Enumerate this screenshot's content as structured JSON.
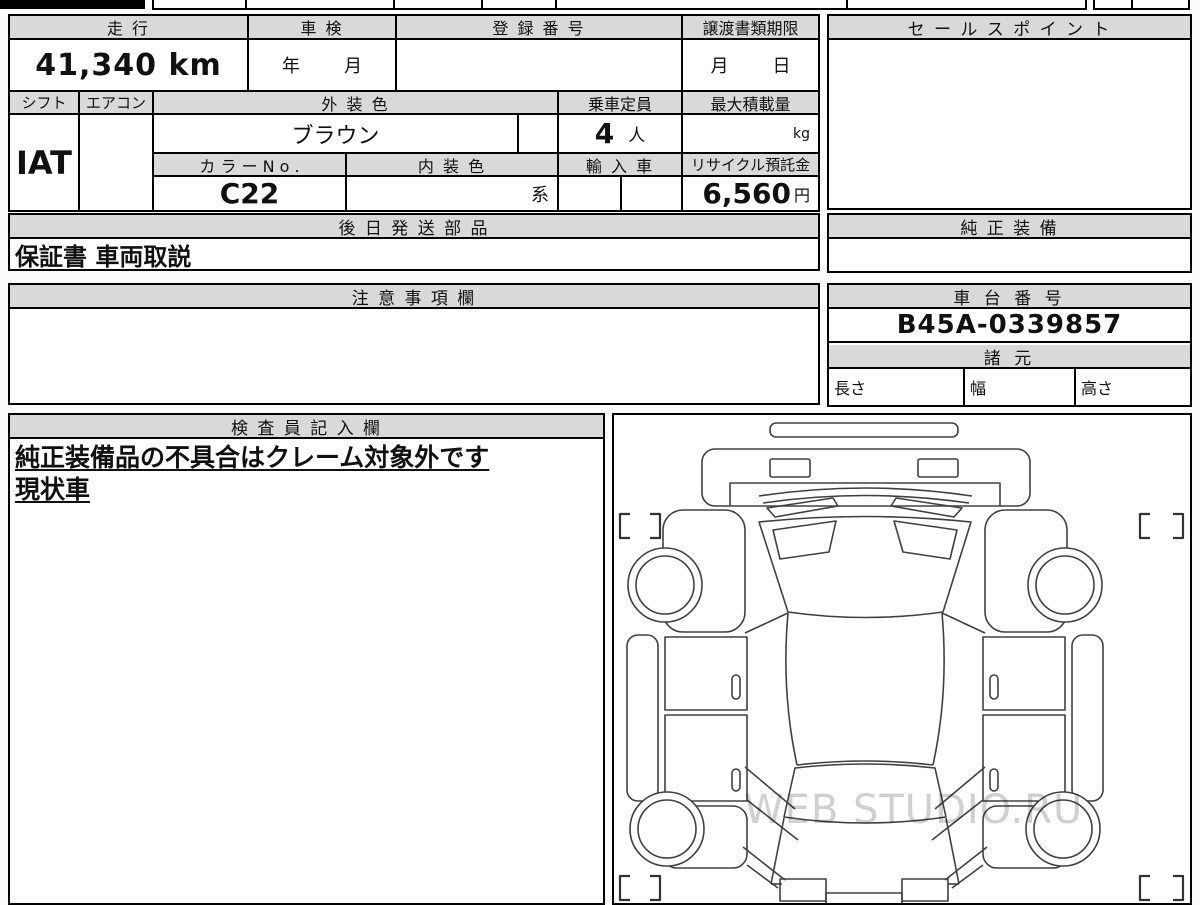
{
  "colors": {
    "header_bg": "#d9d9d9",
    "border": "#000000",
    "diagram_line": "#404040",
    "watermark": "#d0d0d0"
  },
  "table": {
    "headers": {
      "mileage": "走 行",
      "inspection": "車 検",
      "registration": "登 録 番 号",
      "transfer_deadline": "譲渡書類期限",
      "shift": "シフト",
      "aircon": "エアコン",
      "exterior_color": "外 装 色",
      "capacity": "乗車定員",
      "max_load": "最大積載量",
      "color_no": "カ ラ ー N o .",
      "interior_color": "内 装 色",
      "imported": "輸 入 車",
      "recycle_deposit": "リサイクル預託金",
      "later_shipped_parts": "後 日 発 送 部 品"
    },
    "values": {
      "mileage": "41,340 km",
      "inspection_year_label": "年",
      "inspection_month_label": "月",
      "transfer_month_label": "月",
      "transfer_day_label": "日",
      "shift": "IAT",
      "aircon": "",
      "exterior_color": "ブラウン",
      "capacity_number": "4",
      "capacity_unit": "人",
      "max_load_unit": "kg",
      "color_no": "C22",
      "interior_suffix": "系",
      "recycle_amount": "6,560",
      "recycle_unit": "円",
      "later_shipped_parts": "保証書 車両取説"
    }
  },
  "sales_point": {
    "title": "セ ー ル ス ポ イ ン ト",
    "content": ""
  },
  "genuine_equipment": {
    "title": "純 正 装 備",
    "content": ""
  },
  "caution": {
    "title": "注 意 事 項 欄",
    "content": ""
  },
  "chassis": {
    "title": "車 台 番 号",
    "number": "B45A-0339857"
  },
  "specs": {
    "title": "諸 元",
    "length_label": "長さ",
    "width_label": "幅",
    "height_label": "高さ"
  },
  "inspector": {
    "title": "検 査 員 記 入 欄",
    "note1": "純正装備品の不具合はクレーム対象外です",
    "note2": "現状車"
  },
  "diagram": {
    "watermark": "WEB STUDIO.RU"
  }
}
